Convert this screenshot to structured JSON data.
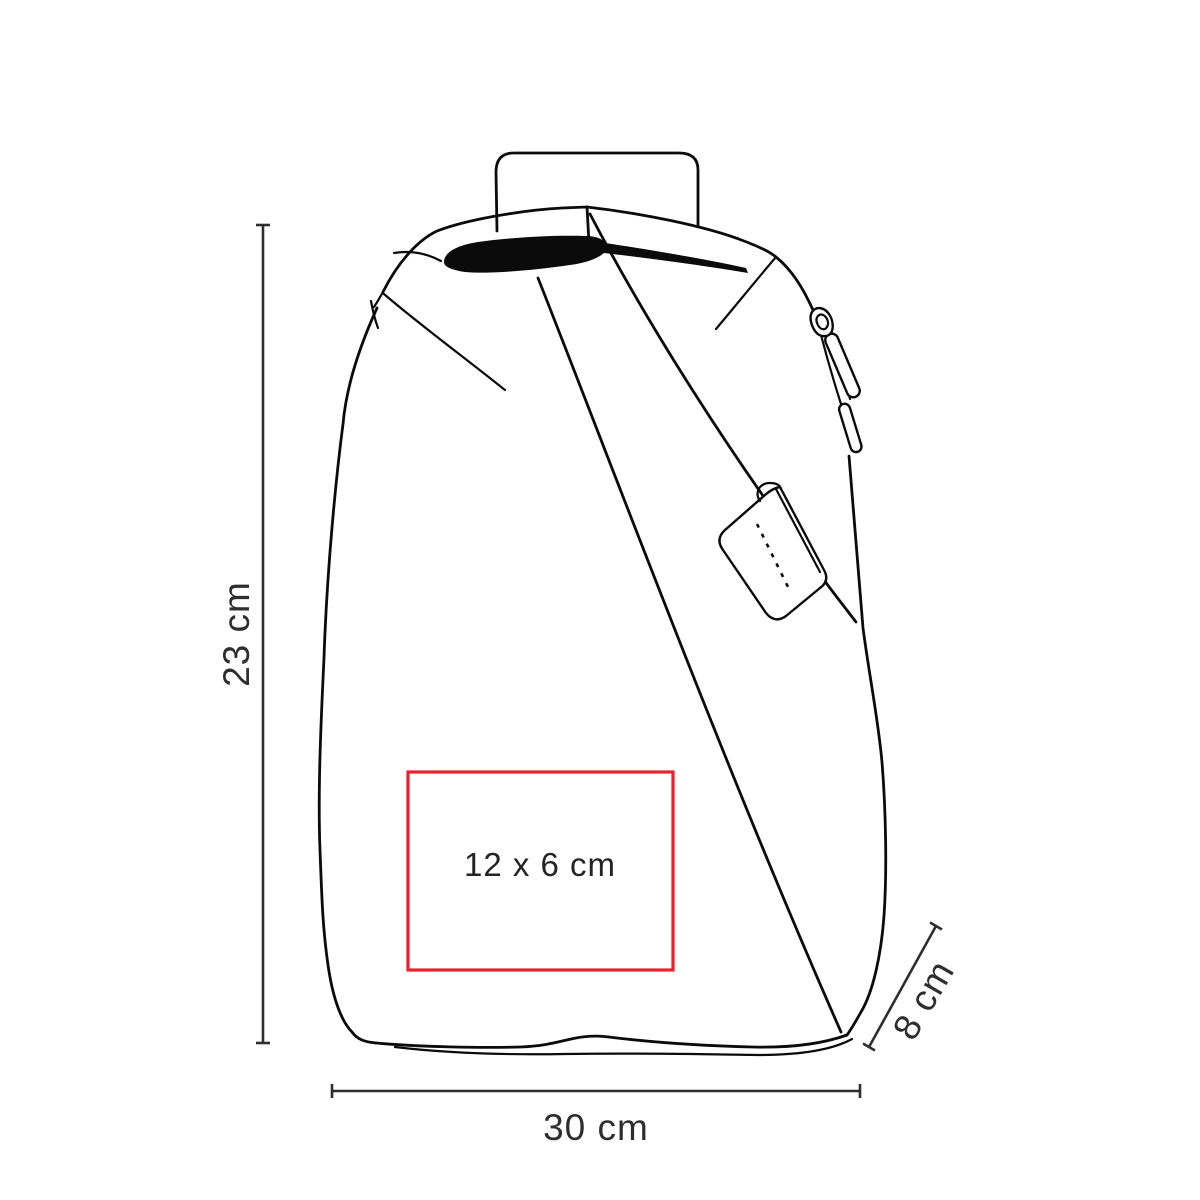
{
  "page": {
    "background": "#ffffff",
    "description": "Technical outline drawing of a crossbody sling backpack with printable area and product dimensions"
  },
  "illustration": {
    "subject": "sling-backpack-line-drawing",
    "line_color": "#0b0b0b",
    "features": [
      "top-handle",
      "roll-top-opening",
      "zipper-pull",
      "diagonal-shoulder-strap",
      "stitched-strap-tag"
    ]
  },
  "print_area": {
    "label": "12 x 6 cm",
    "border_color": "#e8212d"
  },
  "dimensions": {
    "color": "#2e2e2e",
    "height": {
      "label": "23 cm"
    },
    "width": {
      "label": "30 cm"
    },
    "depth": {
      "label": "8 cm"
    }
  }
}
